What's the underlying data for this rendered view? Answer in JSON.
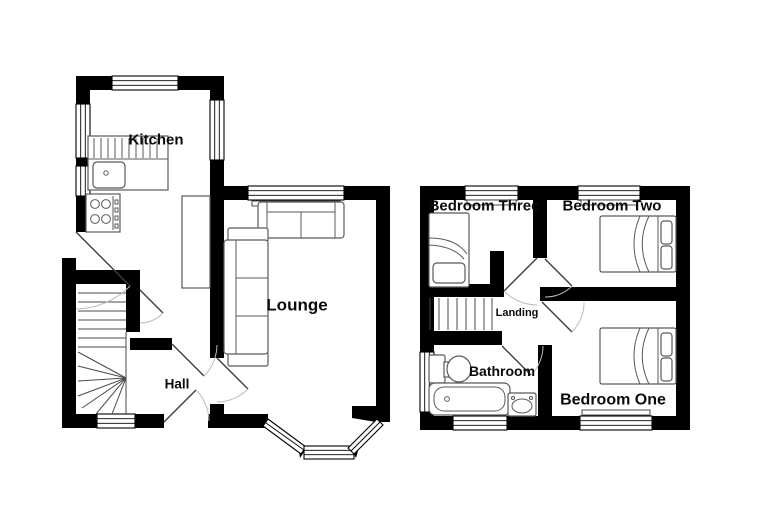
{
  "colors": {
    "wall": "#000000",
    "background": "#ffffff",
    "fixture_line": "#595959",
    "door_leaf": "#3d3d3d",
    "door_arc": "#bbbbbb",
    "label_text": "#0a0a0a"
  },
  "ground_floor": {
    "rooms": [
      {
        "label": "Kitchen"
      },
      {
        "label": "Lounge"
      },
      {
        "label": "Hall"
      }
    ]
  },
  "first_floor": {
    "rooms": [
      {
        "label": "Bedroom Three"
      },
      {
        "label": "Bedroom Two"
      },
      {
        "label": "Bedroom One"
      },
      {
        "label": "Bathroom"
      },
      {
        "label": "Landing"
      }
    ]
  }
}
